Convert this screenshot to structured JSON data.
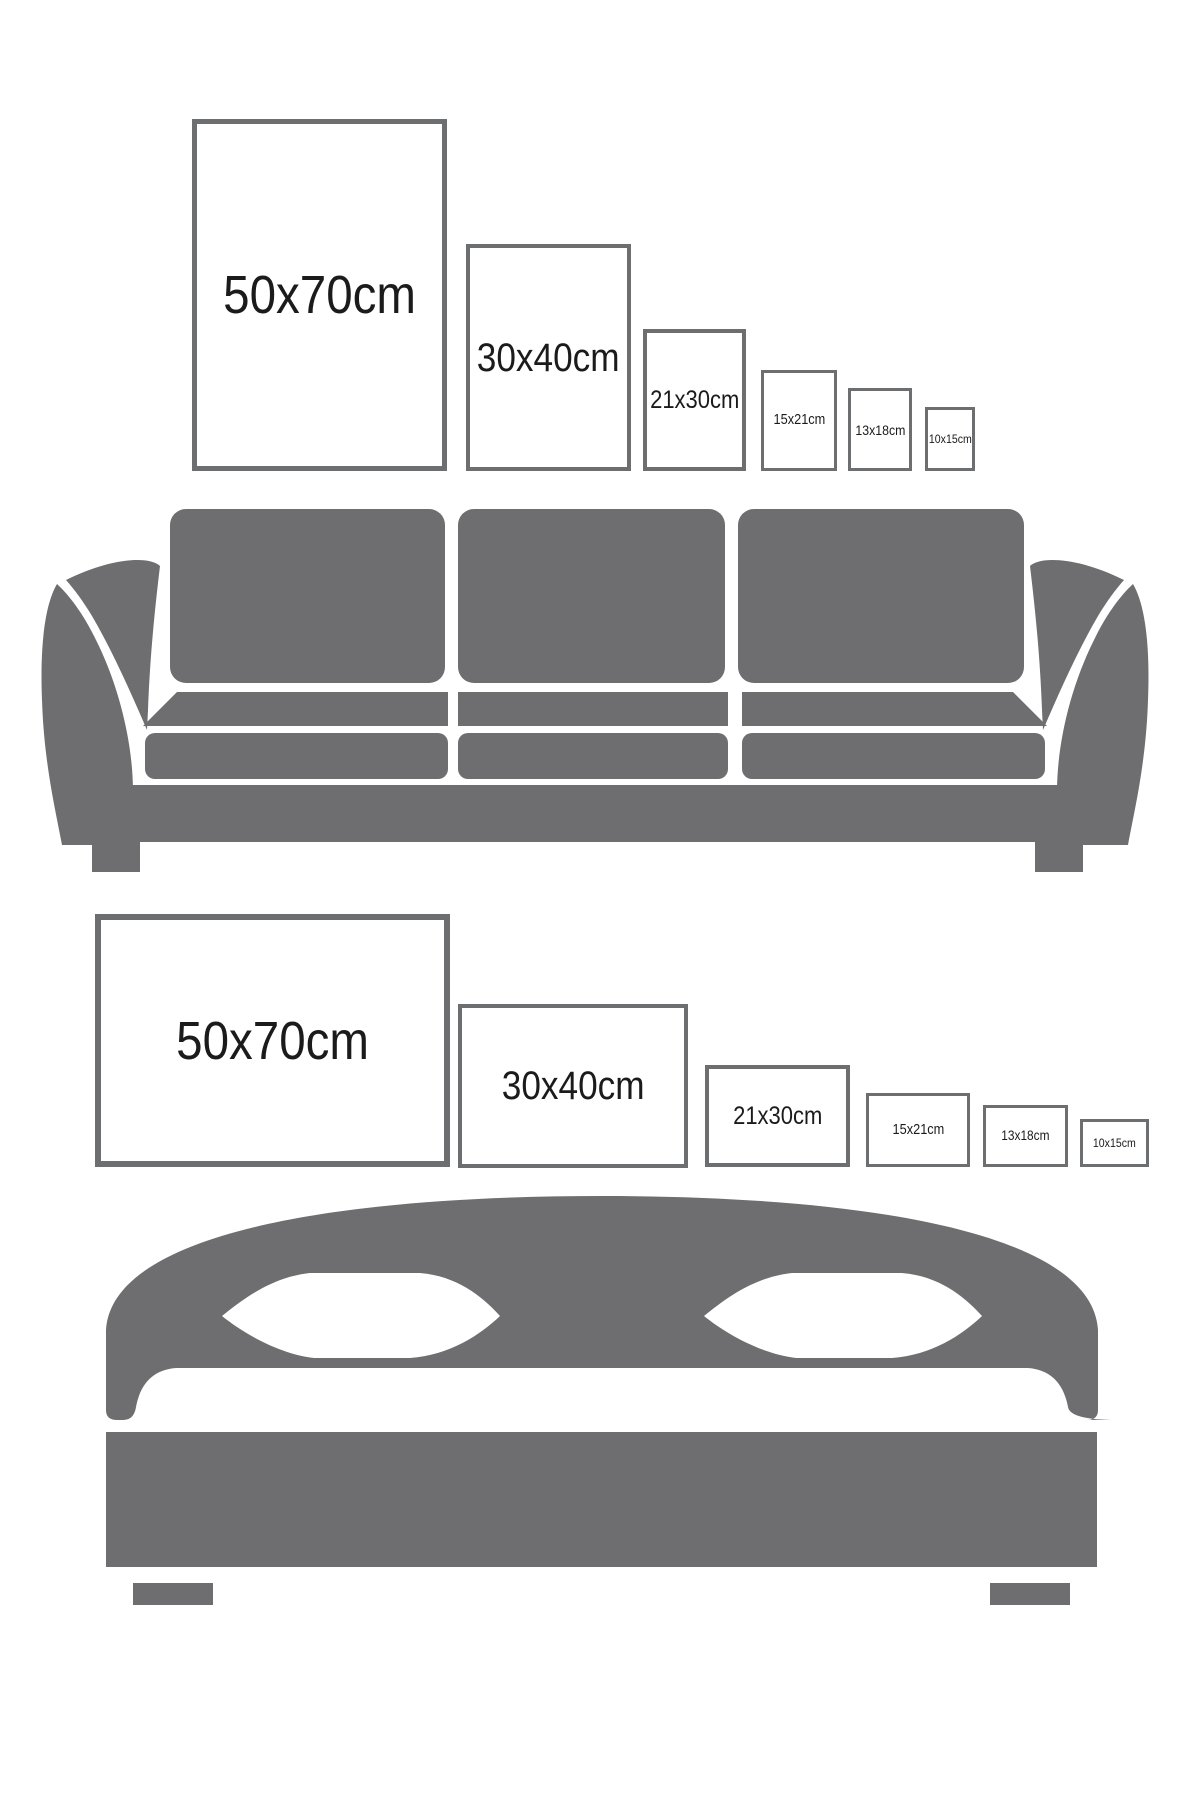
{
  "canvas": {
    "width": 1200,
    "height": 1800,
    "background": "#ffffff"
  },
  "colors": {
    "furniture_gray": "#6e6e70",
    "frame_border": "#6d6e70",
    "label_text": "#1b1b1b",
    "cutout_white": "#ffffff"
  },
  "top_section": {
    "furniture": "sofa",
    "frame_orientation": "portrait",
    "frames": [
      {
        "label": "50x70cm",
        "width_cm": 50,
        "height_cm": 70
      },
      {
        "label": "30x40cm",
        "width_cm": 30,
        "height_cm": 40
      },
      {
        "label": "21x30cm",
        "width_cm": 21,
        "height_cm": 30
      },
      {
        "label": "15x21cm",
        "width_cm": 15,
        "height_cm": 21
      },
      {
        "label": "13x18cm",
        "width_cm": 13,
        "height_cm": 18
      },
      {
        "label": "10x15cm",
        "width_cm": 10,
        "height_cm": 15
      }
    ]
  },
  "bottom_section": {
    "furniture": "bed",
    "frame_orientation": "landscape",
    "frames": [
      {
        "label": "50x70cm",
        "width_cm": 70,
        "height_cm": 50
      },
      {
        "label": "30x40cm",
        "width_cm": 40,
        "height_cm": 30
      },
      {
        "label": "21x30cm",
        "width_cm": 30,
        "height_cm": 21
      },
      {
        "label": "15x21cm",
        "width_cm": 21,
        "height_cm": 15
      },
      {
        "label": "13x18cm",
        "width_cm": 18,
        "height_cm": 13
      },
      {
        "label": "10x15cm",
        "width_cm": 15,
        "height_cm": 10
      }
    ]
  }
}
